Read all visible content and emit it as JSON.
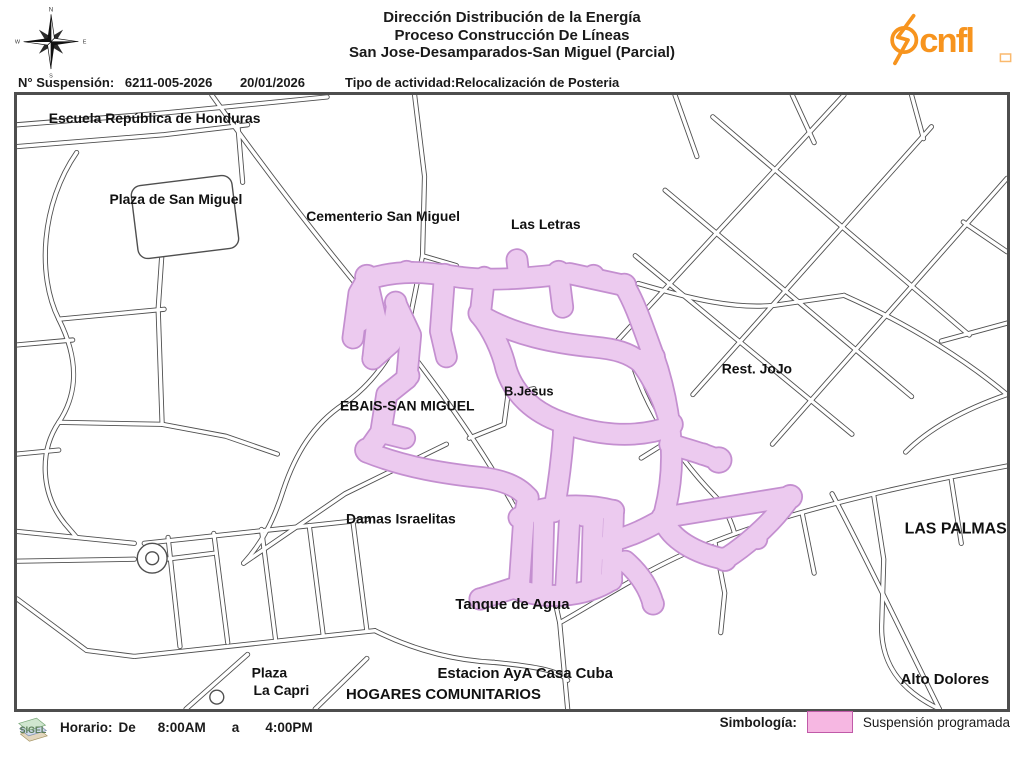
{
  "header": {
    "title_line1": "Dirección Distribución de la Energía",
    "title_line2": "Proceso Construcción De Líneas",
    "title_line3": "San Jose-Desamparados-San Miguel (Parcial)",
    "suspension_label": "N° Suspensión:",
    "suspension_number": "6211-005-2026",
    "suspension_date": "20/01/2026",
    "activity": "Tipo de actividad:Relocalización de Posteria",
    "logo_text": "cnfl",
    "logo_color": "#F7941E",
    "compass": {
      "n": "N",
      "s": "S",
      "e": "E",
      "w": "W"
    }
  },
  "map": {
    "road_color": "#4f4f4f",
    "suspension_fill": "#ECCAEF",
    "suspension_edge": "#C48FD0",
    "labels": [
      {
        "id": "escuela-republica-de-honduras",
        "text": "Escuela República de Honduras",
        "x": 32,
        "y": 28,
        "size": 14
      },
      {
        "id": "plaza-de-san-miguel",
        "text": "Plaza de San Miguel",
        "x": 93,
        "y": 110,
        "size": 14
      },
      {
        "id": "cementerio-san-miguel",
        "text": "Cementerio San Miguel",
        "x": 291,
        "y": 127,
        "size": 14
      },
      {
        "id": "las-letras",
        "text": "Las Letras",
        "x": 497,
        "y": 135,
        "size": 14
      },
      {
        "id": "rest-jojo",
        "text": "Rest. JoJo",
        "x": 709,
        "y": 281,
        "size": 14
      },
      {
        "id": "b-jesus",
        "text": "B.Jesus",
        "x": 490,
        "y": 303,
        "size": 13
      },
      {
        "id": "ebais-san-miguel",
        "text": "EBAIS-SAN MIGUEL",
        "x": 325,
        "y": 318,
        "size": 14
      },
      {
        "id": "damas-israelitas",
        "text": "Damas Israelitas",
        "x": 331,
        "y": 432,
        "size": 14
      },
      {
        "id": "las-palmas",
        "text": "LAS PALMAS",
        "x": 893,
        "y": 442,
        "size": 16
      },
      {
        "id": "tanque-de-agua",
        "text": "Tanque de Agua",
        "x": 441,
        "y": 518,
        "size": 15
      },
      {
        "id": "plaza",
        "text": "Plaza",
        "x": 236,
        "y": 587,
        "size": 14
      },
      {
        "id": "la-capri",
        "text": "La Capri",
        "x": 238,
        "y": 605,
        "size": 14
      },
      {
        "id": "estacion-aya-casa-cuba",
        "text": "Estacion AyA Casa Cuba",
        "x": 423,
        "y": 588,
        "size": 15
      },
      {
        "id": "hogares-comunitarios",
        "text": "HOGARES COMUNITARIOS",
        "x": 331,
        "y": 609,
        "size": 15
      },
      {
        "id": "alto-dolores",
        "text": "Alto Dolores",
        "x": 889,
        "y": 594,
        "size": 15
      }
    ]
  },
  "footer": {
    "sigel_text": "SIGEL",
    "horario_label": "Horario:",
    "de_label": "De",
    "start_time": "8:00AM",
    "a_label": "a",
    "end_time": "4:00PM",
    "simbologia_label": "Simbología:",
    "legend_item": "Suspensión programada",
    "legend_fill": "#F6B7E2",
    "legend_border": "#C05AA8"
  }
}
